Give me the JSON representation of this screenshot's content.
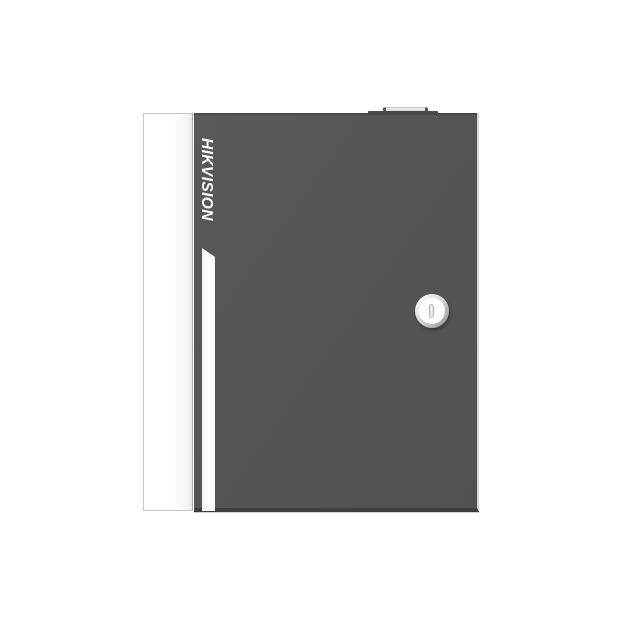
{
  "image": {
    "type": "product-photo",
    "background_color": "#ffffff"
  },
  "brand": {
    "label": "HIKVISION",
    "logo_color": "#ffffff"
  },
  "device": {
    "door_color": "#555457",
    "door_bottom_edge_color": "#3e3e40",
    "door_right_highlight_color": "#d6d6d6",
    "side_panel_color": "#ffffff",
    "accent_stripe_color": "#ffffff",
    "top_tab_color": "#b5b5b5",
    "lock": {
      "ring_color": "#c9c9c9",
      "face_color": "#ffffff",
      "keyhole_color": "#d9d9d9"
    }
  }
}
